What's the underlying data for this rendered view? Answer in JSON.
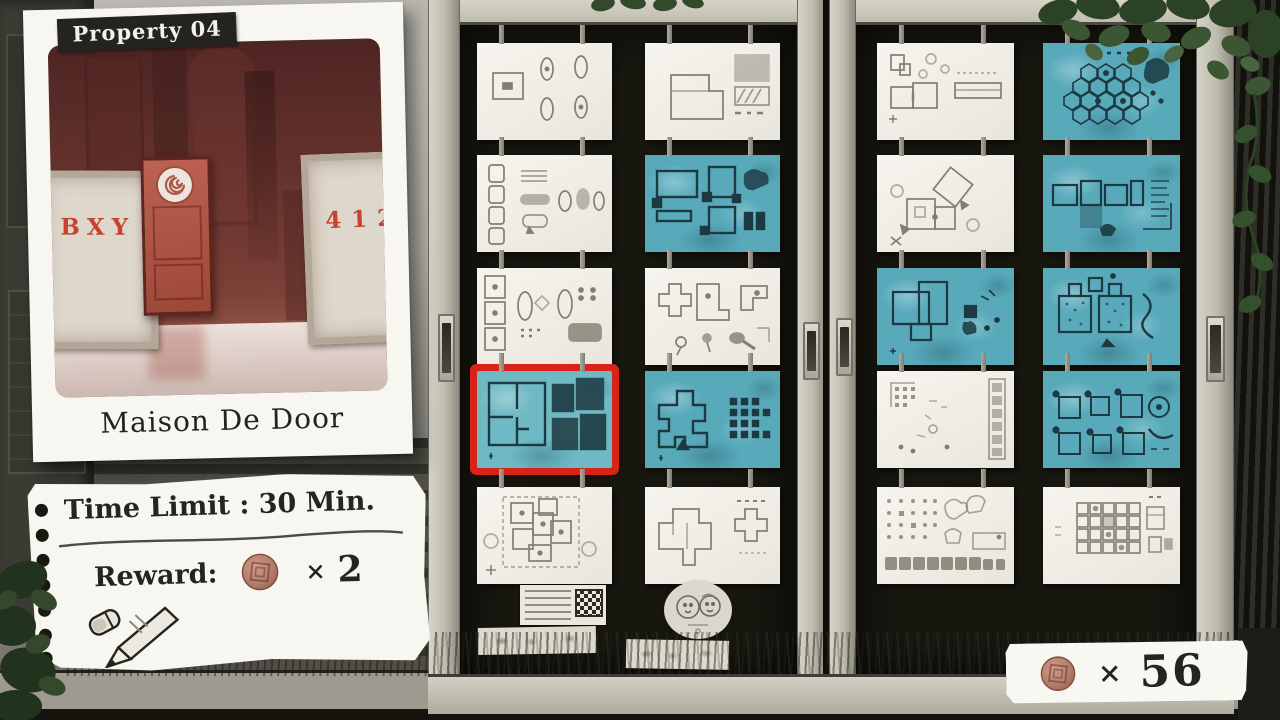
{
  "property_card": {
    "label": "Property 04",
    "title": "Maison De Door",
    "photo": {
      "left_sign_text": "BXY",
      "right_sign_text": "412"
    }
  },
  "note": {
    "time_limit_text": "Time Limit : 30 Min.",
    "reward_label": "Reward:",
    "reward_times_symbol": "×",
    "reward_count": "2"
  },
  "wallet": {
    "times_symbol": "×",
    "count": "56"
  },
  "doors": {
    "left": {
      "cards": [
        {
          "css": "card white"
        },
        {
          "css": "card white"
        },
        {
          "css": "card white"
        },
        {
          "css": "card teal"
        },
        {
          "css": "card white"
        },
        {
          "css": "card white"
        },
        {
          "css": "card teal selected"
        },
        {
          "css": "card teal"
        },
        {
          "css": "card white"
        },
        {
          "css": "card white"
        }
      ]
    },
    "right": {
      "cards": [
        {
          "css": "card white"
        },
        {
          "css": "card teal"
        },
        {
          "css": "card white"
        },
        {
          "css": "card teal"
        },
        {
          "css": "card teal"
        },
        {
          "css": "card teal"
        },
        {
          "css": "card white"
        },
        {
          "css": "card teal"
        },
        {
          "css": "card white"
        },
        {
          "css": "card white"
        }
      ]
    }
  },
  "colors": {
    "teal_card": "#58aabb",
    "selected_border": "#d8231b",
    "coin_copper": "#b07a69"
  }
}
